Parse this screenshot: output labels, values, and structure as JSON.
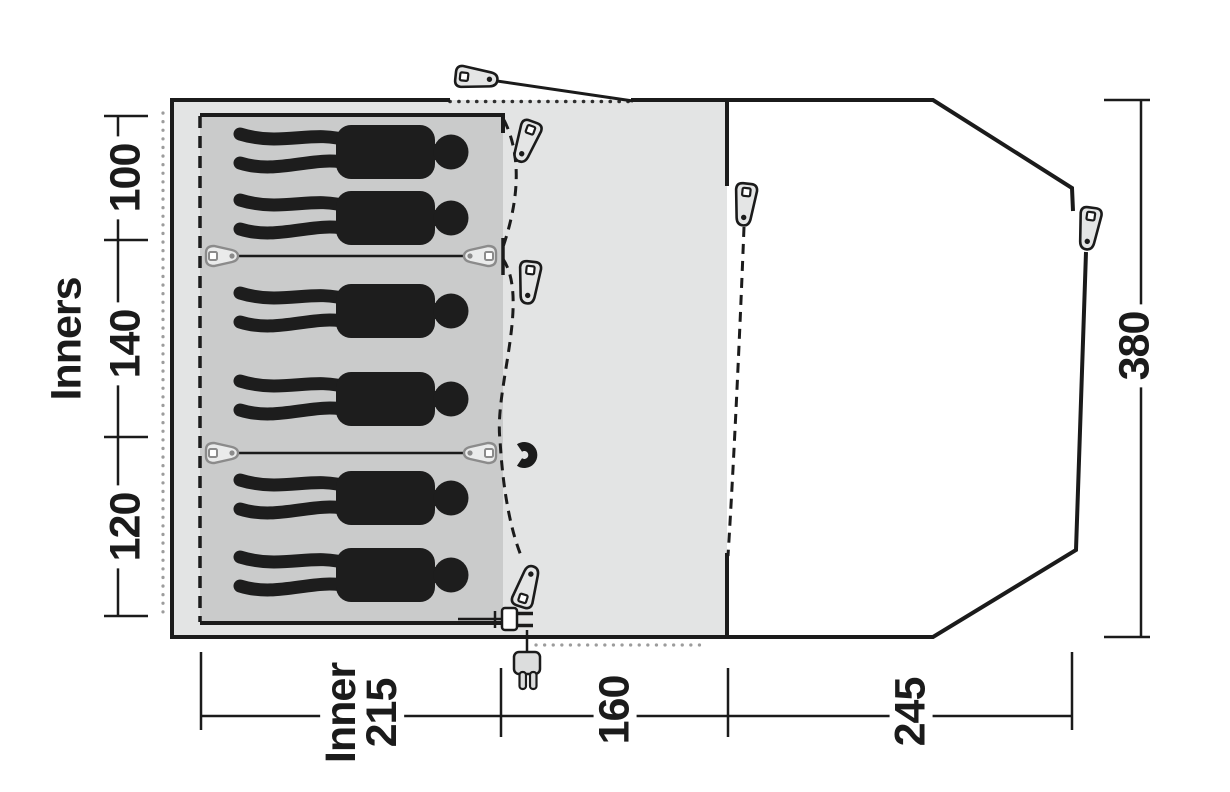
{
  "title": "Tent floor plan top view with dimensions",
  "labels": {
    "inners": "Inners",
    "cabin_100": "100",
    "cabin_140": "140",
    "cabin_120": "120",
    "inner_depth_line1": "Inner",
    "inner_depth_line2": "215",
    "living_160": "160",
    "porch_245": "245",
    "width_380": "380"
  },
  "figures": {
    "sleeping_silhouettes": 6,
    "sleeping_compartments": 3
  },
  "icons": {
    "peg": "tent-peg-icon",
    "toggle": "toggle-peg-icon",
    "magnet": "magnet-icon",
    "plug_inside": "power-plug-icon",
    "plug_outside": "power-plug-external-icon",
    "person": "person-silhouette-icon"
  },
  "colors": {
    "body_fill": "#e3e4e4",
    "inner_cabin_fill": "#cacbcb",
    "porch_fill": "#ffffff",
    "line": "#1b1b1b",
    "silhouette": "#1d1d1d",
    "dots": "#9c9c9c",
    "toggle_gray": "#8b8b8b"
  }
}
